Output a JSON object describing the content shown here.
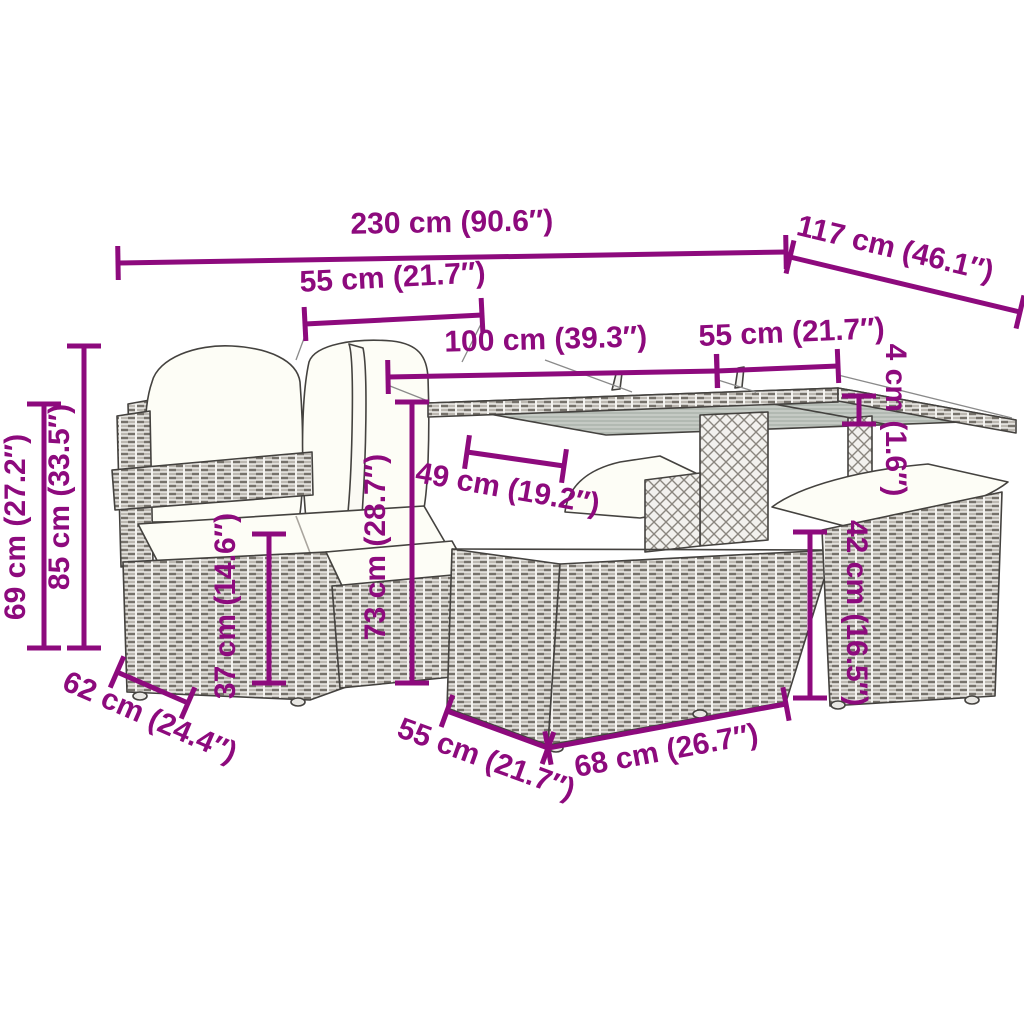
{
  "colors": {
    "dimension": "#8d0a7d",
    "outline": "#44423f",
    "leader": "#8a8a8a",
    "cushion": "#fdfdf6",
    "background": "#ffffff"
  },
  "annotation_font_px": 30,
  "dimensions": [
    {
      "id": "total-width",
      "label": "230 cm (90.6″)",
      "x1": 118,
      "y1": 263,
      "x2": 786,
      "y2": 252,
      "lx": 452,
      "ly": 232,
      "rot": -1
    },
    {
      "id": "total-depth",
      "label": "117 cm (46.1″)",
      "x1": 790,
      "y1": 257,
      "x2": 1020,
      "y2": 312,
      "lx": 893,
      "ly": 258,
      "rot": 13.5
    },
    {
      "id": "seat-width",
      "label": "55 cm (21.7″)",
      "x1": 305,
      "y1": 324,
      "x2": 482,
      "y2": 315,
      "lx": 393,
      "ly": 287,
      "rot": -3
    },
    {
      "id": "table-length",
      "label": "100 cm (39.3″)",
      "x1": 388,
      "y1": 377,
      "x2": 717,
      "y2": 371,
      "lx": 546,
      "ly": 349,
      "rot": -1.5
    },
    {
      "id": "table-depth",
      "label": "55 cm (21.7″)",
      "x1": 717,
      "y1": 371,
      "x2": 838,
      "y2": 366,
      "lx": 792,
      "ly": 342,
      "rot": -2.5
    },
    {
      "id": "tabletop-thickness",
      "label": "4 cm (1.6″)",
      "x1": 859,
      "y1": 396,
      "x2": 859,
      "y2": 424,
      "lx": 886,
      "ly": 420,
      "rot": 90
    },
    {
      "id": "seat-height",
      "label": "69 cm (27.2″)",
      "x1": 44,
      "y1": 404,
      "x2": 44,
      "y2": 648,
      "lx": 25,
      "ly": 527,
      "rot": -90
    },
    {
      "id": "back-height",
      "label": "85 cm (33.5″)",
      "x1": 84,
      "y1": 346,
      "x2": 84,
      "y2": 648,
      "lx": 69,
      "ly": 497,
      "rot": -90
    },
    {
      "id": "stool-height-left",
      "label": "37 cm (14.6″)",
      "x1": 269,
      "y1": 534,
      "x2": 269,
      "y2": 683,
      "lx": 235,
      "ly": 606,
      "rot": -90
    },
    {
      "id": "table-height",
      "label": "73 cm (28.7″)",
      "x1": 412,
      "y1": 402,
      "x2": 412,
      "y2": 683,
      "lx": 385,
      "ly": 547,
      "rot": -90
    },
    {
      "id": "table-clearance",
      "label": "49 cm (19.2″)",
      "x1": 467,
      "y1": 452,
      "x2": 564,
      "y2": 466,
      "lx": 506,
      "ly": 498,
      "rot": 10
    },
    {
      "id": "stool-height-right",
      "label": "42 cm (16.5″)",
      "x1": 810,
      "y1": 532,
      "x2": 810,
      "y2": 698,
      "lx": 847,
      "ly": 613,
      "rot": 90
    },
    {
      "id": "sofa-depth",
      "label": "62 cm (24.4″)",
      "x1": 117,
      "y1": 672,
      "x2": 188,
      "y2": 703,
      "lx": 146,
      "ly": 726,
      "rot": 23.5
    },
    {
      "id": "cube-depth",
      "label": "55 cm (21.7″)",
      "x1": 447,
      "y1": 711,
      "x2": 548,
      "y2": 748,
      "lx": 483,
      "ly": 768,
      "rot": 20
    },
    {
      "id": "cube-width",
      "label": "68 cm (26.7″)",
      "x1": 548,
      "y1": 748,
      "x2": 786,
      "y2": 704,
      "lx": 668,
      "ly": 760,
      "rot": -10.5
    }
  ],
  "leader_lines": [
    {
      "x1": 306,
      "y1": 333,
      "x2": 296,
      "y2": 360
    },
    {
      "x1": 481,
      "y1": 324,
      "x2": 462,
      "y2": 362
    },
    {
      "x1": 390,
      "y1": 386,
      "x2": 428,
      "y2": 401
    },
    {
      "x1": 718,
      "y1": 380,
      "x2": 756,
      "y2": 392
    },
    {
      "x1": 838,
      "y1": 375,
      "x2": 1012,
      "y2": 418
    },
    {
      "x1": 545,
      "y1": 360,
      "x2": 632,
      "y2": 392
    }
  ]
}
